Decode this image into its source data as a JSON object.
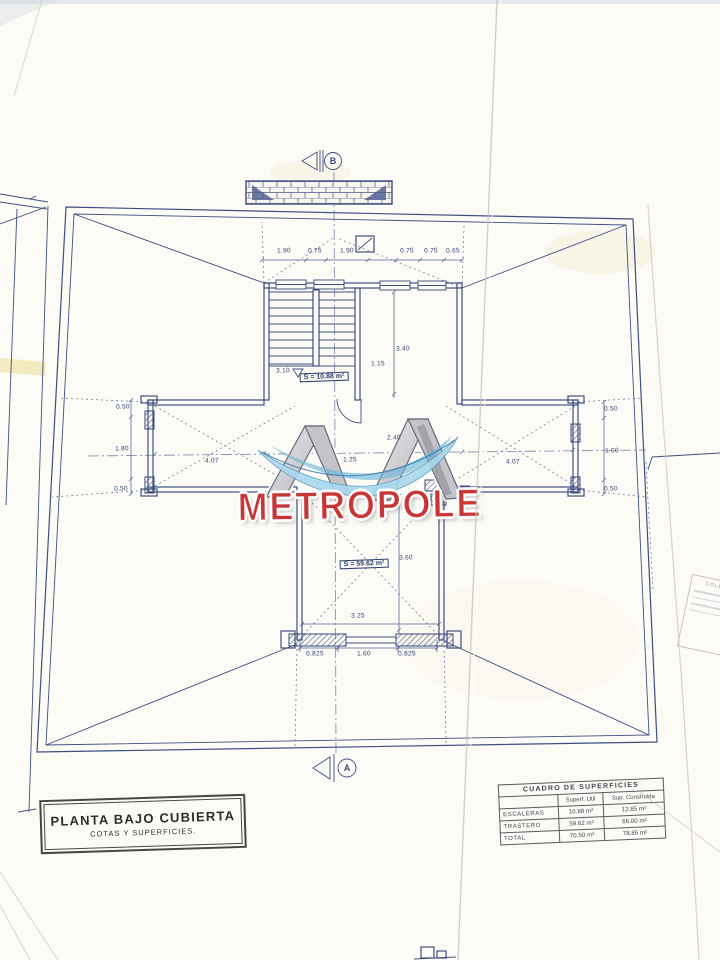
{
  "page": {
    "background": "#fcfbf6",
    "ink_color": "#3e4e82"
  },
  "watermark": {
    "brand": "METROPOLE",
    "brand_color": "#c73535"
  },
  "section_markers": {
    "top_label": "B",
    "bottom_label": "A"
  },
  "title_block": {
    "line1": "PLANTA BAJO CUBIERTA",
    "line2": "COTAS Y SUPERFICIES."
  },
  "areas_table": {
    "title": "CUADRO DE SUPERFICIES",
    "columns": [
      "",
      "Superf. Util",
      "Sup. Construida"
    ],
    "rows": [
      {
        "label": "ESCALERAS",
        "util": "10.88 m²",
        "construida": "12.85 m²"
      },
      {
        "label": "TRASTERO",
        "util": "59.62 m²",
        "construida": "66.00 m²"
      },
      {
        "label": "TOTAL",
        "util": "70.50 m²",
        "construida": "78.85 m²"
      }
    ]
  },
  "room_labels": {
    "stairs": "S = 10.88 m²",
    "trastero": "S = 59.62 m²"
  },
  "dims": {
    "top": [
      "1.90",
      "0.75",
      "1.90",
      "0.75",
      "0.75",
      "0.65"
    ],
    "stair_height": "3.10",
    "landing_width": "1.15",
    "room_height": "3.40",
    "wing_left_length": "4.07",
    "wing_right_length": "4.07",
    "left_top": "0.50",
    "left_mid": "1.80",
    "left_bottom": "0.50",
    "right_top": "0.50",
    "right_mid": "1.60",
    "right_bottom": "0.50",
    "center_width": "2.40",
    "center_span": "1.25",
    "trastero_height": "3.60",
    "trastero_width": "3.25",
    "bottom": [
      "0.825",
      "1.60",
      "0.825"
    ]
  },
  "stamp": {
    "text": "COLE"
  }
}
